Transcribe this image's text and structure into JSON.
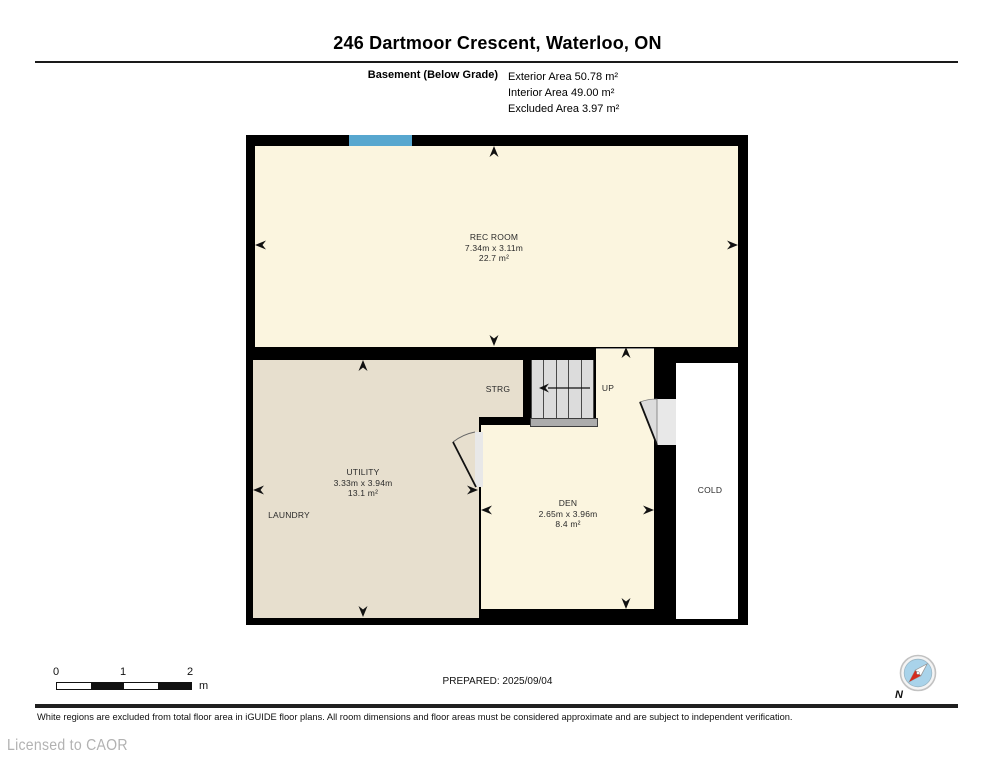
{
  "header": {
    "title": "246 Dartmoor Crescent, Waterloo, ON",
    "floor_label": "Basement (Below Grade)",
    "exterior_area": "Exterior Area 50.78 m²",
    "interior_area": "Interior Area 49.00 m²",
    "excluded_area": "Excluded Area 3.97 m²"
  },
  "plan": {
    "rooms": {
      "rec_room": {
        "name": "REC ROOM",
        "dims": "7.34m x 3.11m",
        "area": "22.7 m²"
      },
      "utility": {
        "name": "UTILITY",
        "dims": "3.33m x 3.94m",
        "area": "13.1 m²"
      },
      "den": {
        "name": "DEN",
        "dims": "2.65m x 3.96m",
        "area": "8.4 m²"
      },
      "laundry_label": "LAUNDRY",
      "storage_label": "STRG",
      "stairs_label": "UP",
      "cold_label": "COLD"
    },
    "colors": {
      "wall": "#000000",
      "floor_fill": "#FBF5DF",
      "utility_fill": "#E7DFCE",
      "cold_fill": "#FFFFFF",
      "window": "#57A7CF"
    }
  },
  "footer": {
    "scale": {
      "ticks": [
        "0",
        "1",
        "2"
      ],
      "unit": "m"
    },
    "prepared": "PREPARED: 2025/09/04",
    "compass_north": "N",
    "disclaimer": "White regions are excluded from total floor area in iGUIDE floor plans. All room dimensions and floor areas must be considered approximate and are subject to independent verification.",
    "license": "Licensed to CAOR"
  }
}
